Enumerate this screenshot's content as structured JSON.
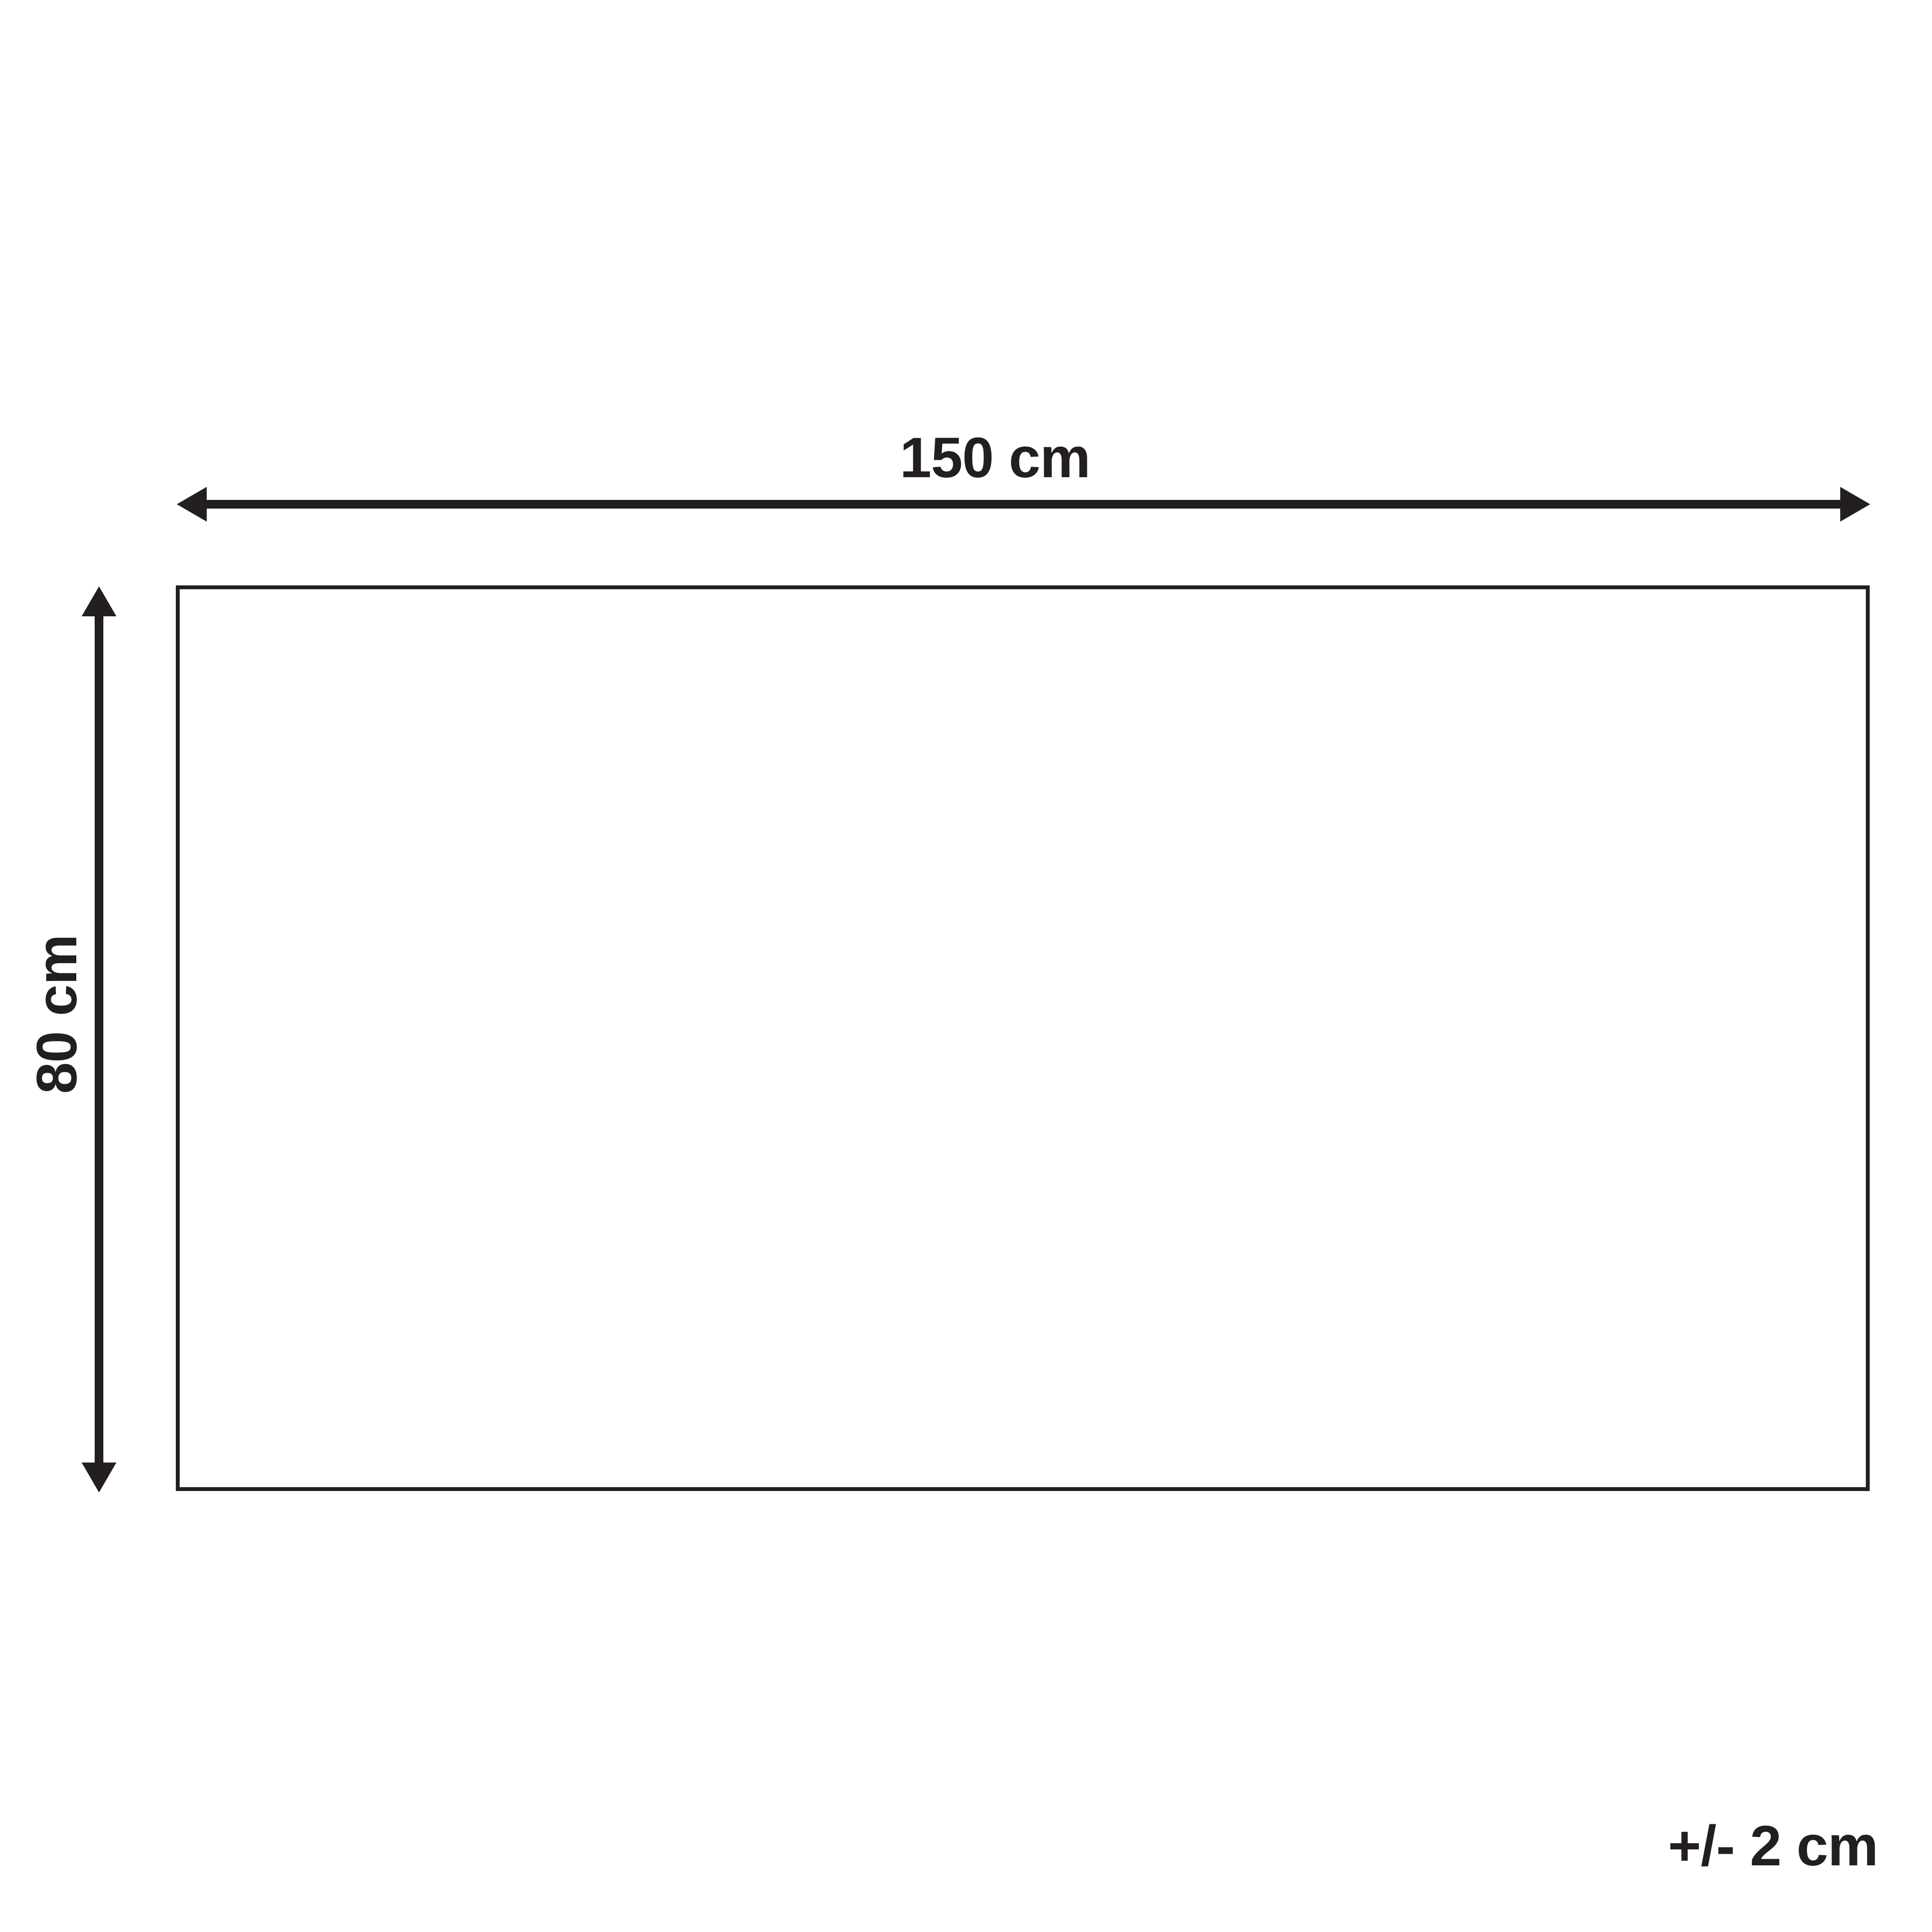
{
  "diagram": {
    "type": "product-dimension-drawing",
    "shape": "rectangle",
    "width_label": "150 cm",
    "height_label": "80 cm",
    "tolerance_label": "+/- 2 cm",
    "ink_color": "#231f20",
    "background_color": "#ffffff"
  }
}
